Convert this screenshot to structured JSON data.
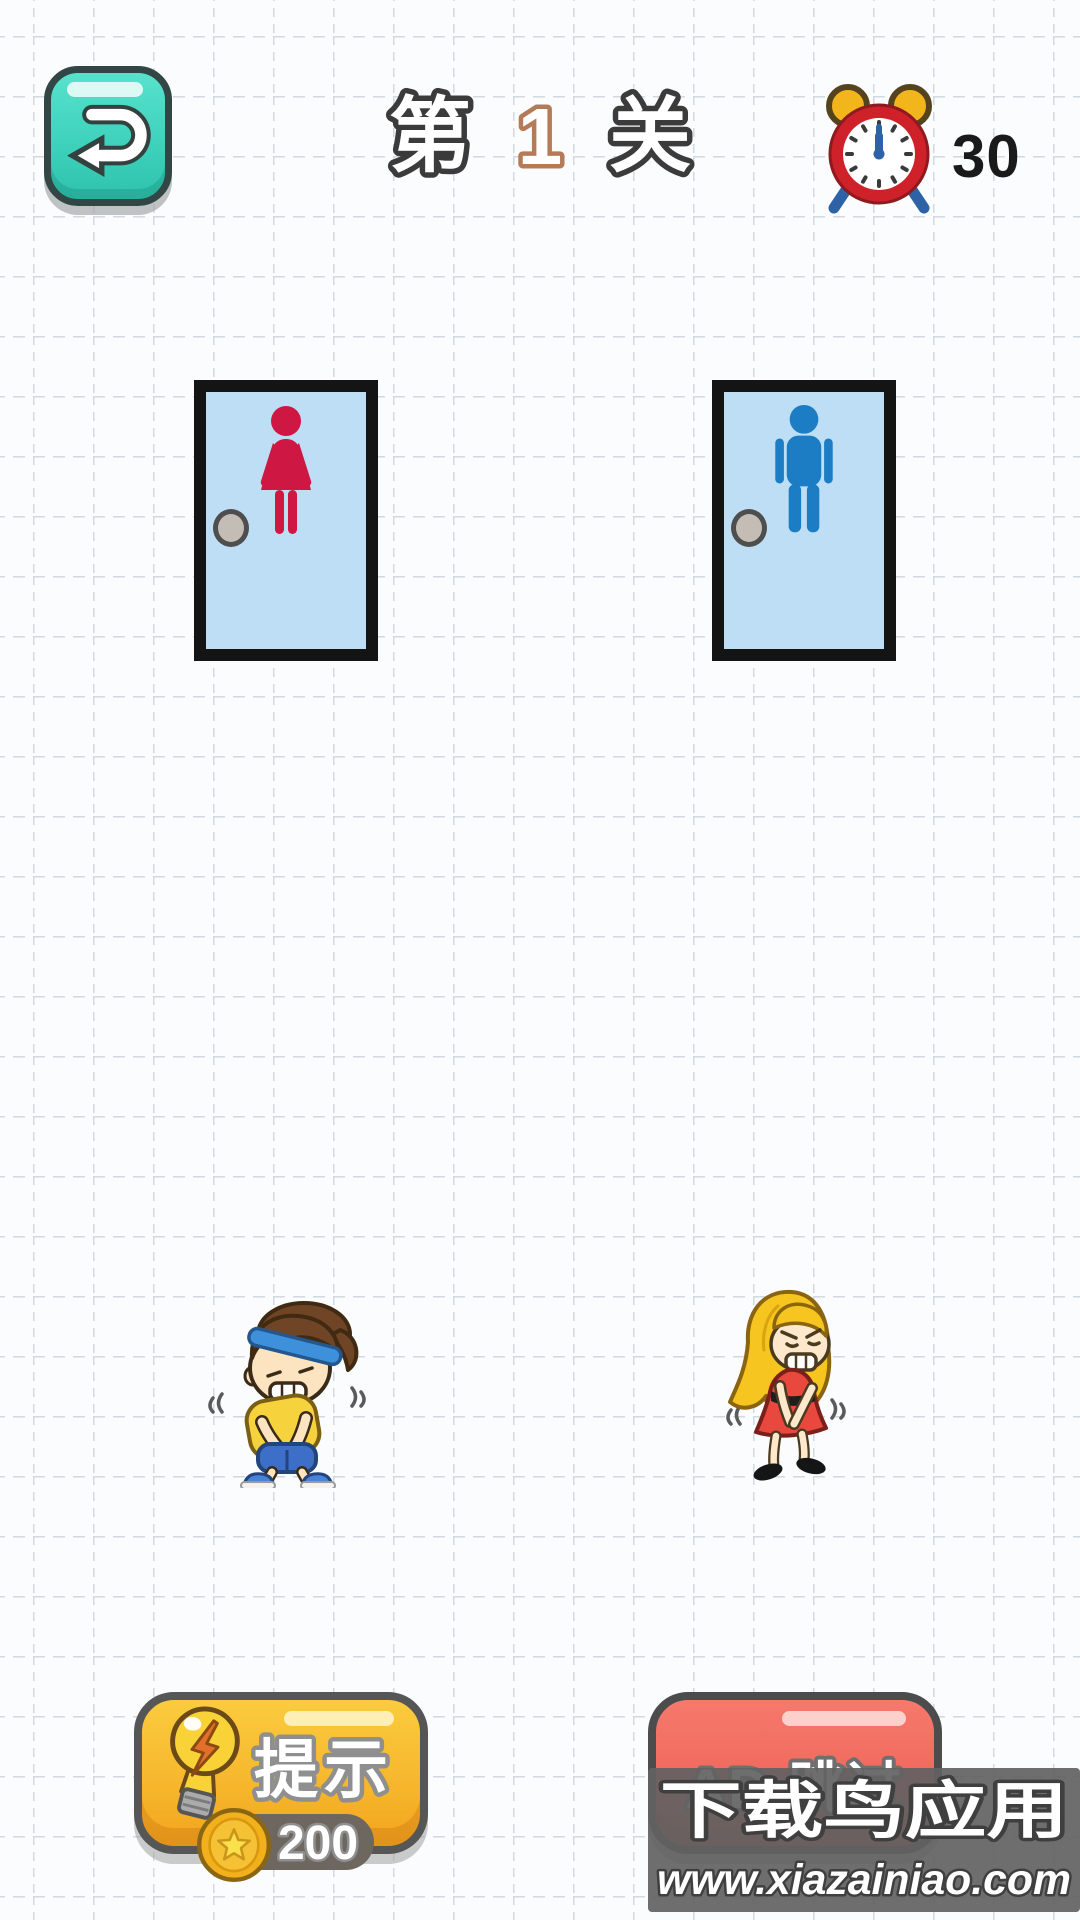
{
  "header": {
    "back_button": {
      "icon": "undo-return-arrow-icon"
    },
    "level": {
      "prefix": "第",
      "number": "1",
      "suffix": "关"
    },
    "timer": {
      "icon": "alarm-clock-icon",
      "value": "30"
    }
  },
  "doors": {
    "women": {
      "icon": "woman-figure-icon",
      "figure_color": "#ce1743",
      "fill": "#bedef5"
    },
    "men": {
      "icon": "man-figure-icon",
      "figure_color": "#1c7dc4",
      "fill": "#bedef5"
    }
  },
  "characters": {
    "boy": {
      "icon": "boy-needs-toilet-figure"
    },
    "girl": {
      "icon": "girl-needs-toilet-figure"
    }
  },
  "footer": {
    "hint_button": {
      "icon": "lightbulb-icon",
      "label": "提示",
      "cost": "200",
      "cost_icon": "coin-icon"
    },
    "ad_skip_button": {
      "label": "AD 跳过"
    }
  },
  "watermark": {
    "title": "下载鸟应用",
    "url": "www.xiazainiao.com"
  },
  "colors": {
    "background": "#fbfcfd",
    "grid_line": "#d2d9e1",
    "back_button": "#3ed2bc",
    "door_fill": "#bedef5",
    "door_border": "#141414",
    "women_figure": "#ce1743",
    "men_figure": "#1c7dc4",
    "hint_button": "#f6b62c",
    "ad_button": "#f0685c",
    "timer_text": "#1a1a1a",
    "level_outline": "#3b3b3b",
    "level_number_outline": "#b57a56",
    "watermark_bg": "#626262"
  }
}
